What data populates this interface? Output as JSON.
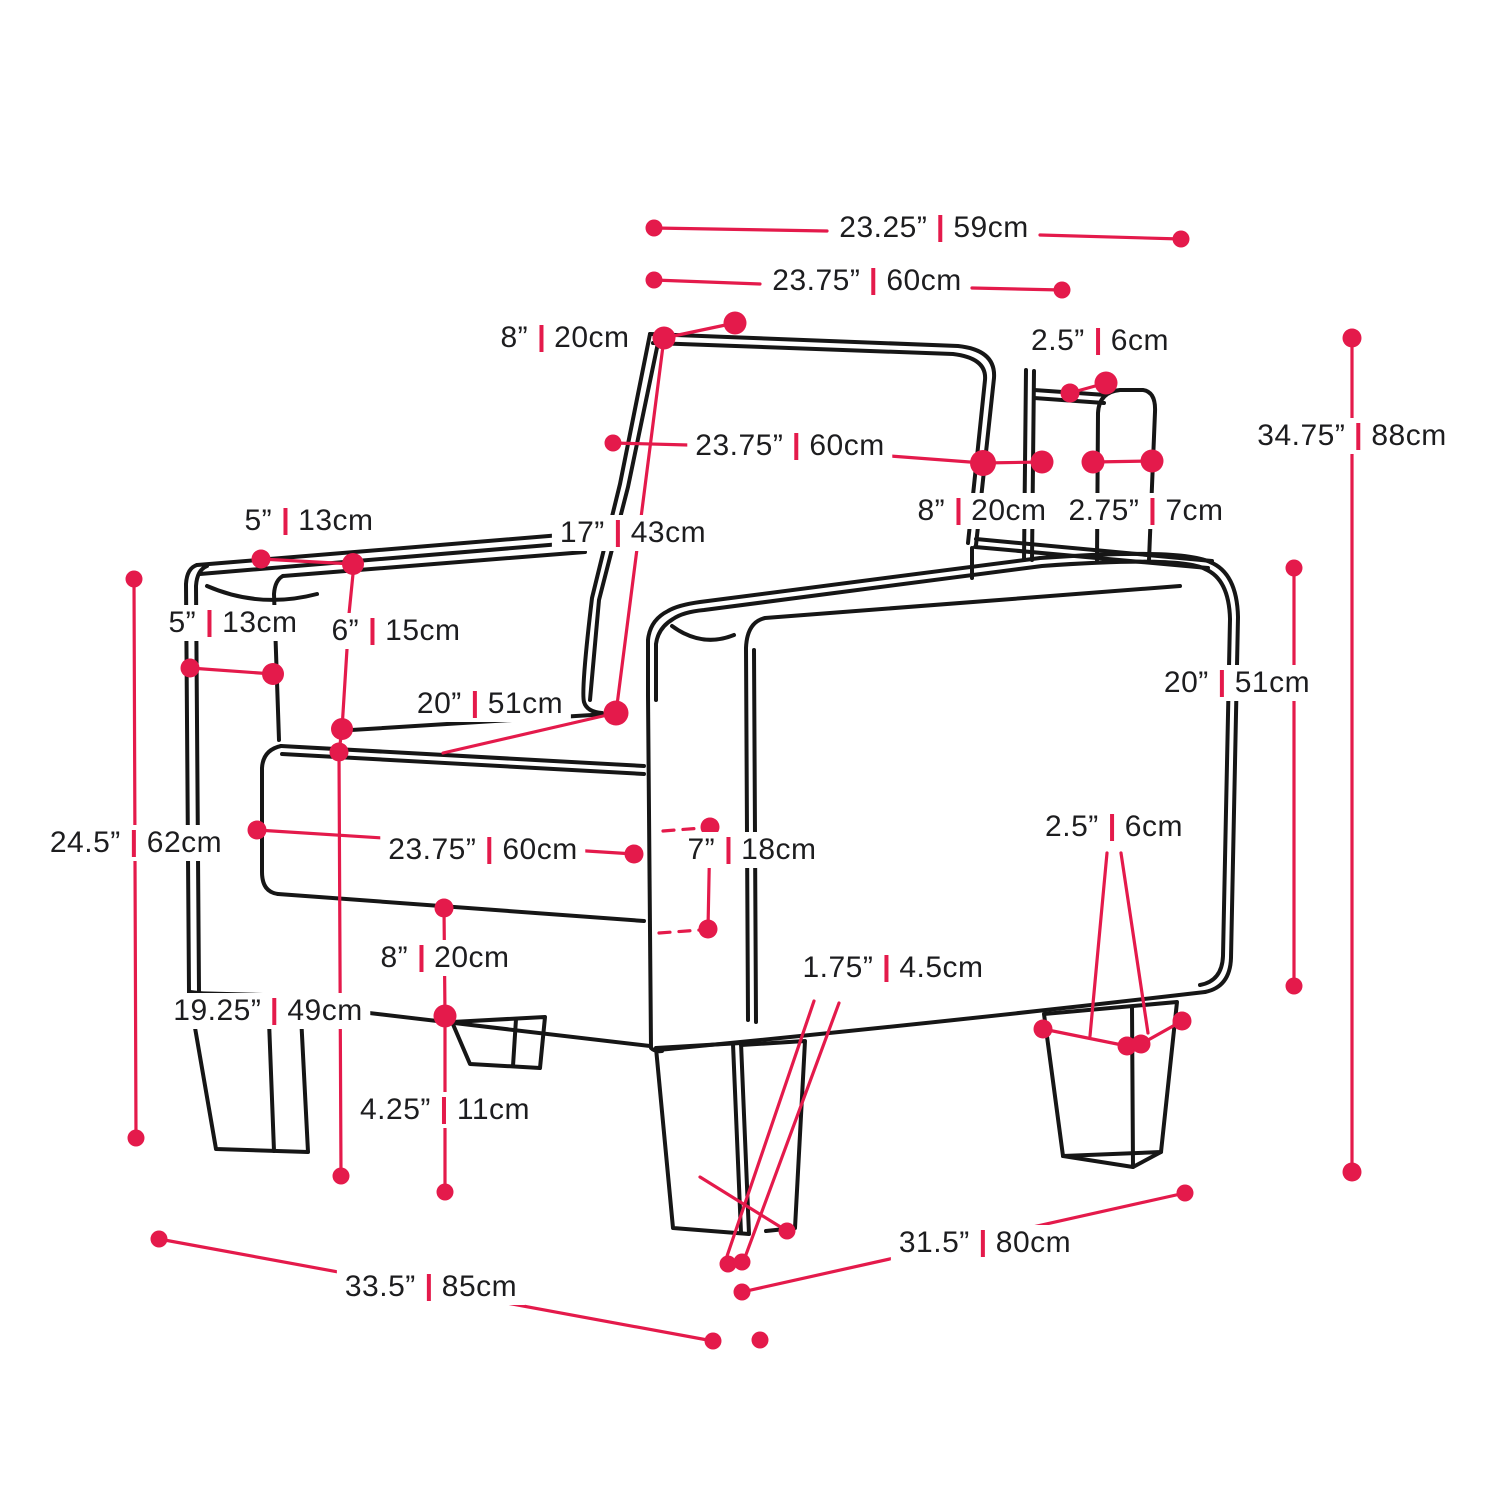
{
  "diagram": {
    "kind": "furniture-dimension-diagram",
    "subject": "armchair line drawing with imperial and metric measurements"
  },
  "colors": {
    "accent": "#E41A4B",
    "line_art": "#161616",
    "text": "#1d1d1f",
    "background": "#ffffff"
  },
  "dimensions": [
    {
      "id": "back-top-width",
      "in": "23.25”",
      "cm": "59cm"
    },
    {
      "id": "back-top-inner-width",
      "in": "23.75”",
      "cm": "60cm"
    },
    {
      "id": "back-top-left-depth",
      "in": "8”",
      "cm": "20cm"
    },
    {
      "id": "rear-arm-top-gap",
      "in": "2.5”",
      "cm": "6cm"
    },
    {
      "id": "backrest-width",
      "in": "23.75”",
      "cm": "60cm"
    },
    {
      "id": "back-to-rear-arm",
      "in": "8”",
      "cm": "20cm"
    },
    {
      "id": "rear-arm-width",
      "in": "2.75”",
      "cm": "7cm"
    },
    {
      "id": "overall-height",
      "in": "34.75”",
      "cm": "88cm"
    },
    {
      "id": "arm-top-width",
      "in": "5”",
      "cm": "13cm"
    },
    {
      "id": "backrest-height",
      "in": "17”",
      "cm": "43cm"
    },
    {
      "id": "arm-front-width",
      "in": "5”",
      "cm": "13cm"
    },
    {
      "id": "arm-above-seat",
      "in": "6”",
      "cm": "15cm"
    },
    {
      "id": "seat-depth",
      "in": "20”",
      "cm": "51cm"
    },
    {
      "id": "side-panel-height",
      "in": "20”",
      "cm": "51cm"
    },
    {
      "id": "arm-height",
      "in": "24.5”",
      "cm": "62cm"
    },
    {
      "id": "seat-width",
      "in": "23.75”",
      "cm": "60cm"
    },
    {
      "id": "seat-cushion-side",
      "in": "7”",
      "cm": "18cm"
    },
    {
      "id": "rear-leg-width",
      "in": "2.5”",
      "cm": "6cm"
    },
    {
      "id": "cushion-to-base",
      "in": "8”",
      "cm": "20cm"
    },
    {
      "id": "seat-height",
      "in": "19.25”",
      "cm": "49cm"
    },
    {
      "id": "leg-bottom-width",
      "in": "1.75”",
      "cm": "4.5cm"
    },
    {
      "id": "leg-height",
      "in": "4.25”",
      "cm": "11cm"
    },
    {
      "id": "overall-width",
      "in": "33.5”",
      "cm": "85cm"
    },
    {
      "id": "overall-depth",
      "in": "31.5”",
      "cm": "80cm"
    }
  ]
}
